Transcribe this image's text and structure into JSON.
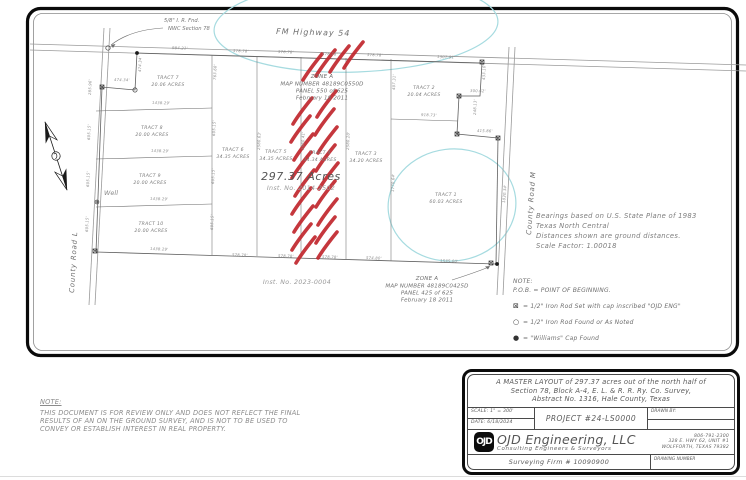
{
  "colors": {
    "flood_hatch": "#c1272d",
    "wetland_outline": "#a6dbe0",
    "drawing_line": "#555555",
    "drawing_text": "#7a7a7a"
  },
  "map": {
    "highway_label": "FM Highway 54",
    "road_left_label": "County Road L",
    "road_right_label": "County Road M",
    "nwc_note_line1": "5/8\" I. R. Fnd.",
    "nwc_note_line2": "NWC Section 78",
    "well_label": "Well",
    "area_label": "297.37 Acres",
    "area_inst_label": "Inst. No. 2014-2502",
    "inst_label_sw": "Inst. No. 2023-0004",
    "zone_a_north": {
      "lines": [
        "ZONE A",
        "MAP NUMBER 48189C0550D",
        "PANEL 550 of 625",
        "February 18 2011"
      ]
    },
    "zone_a_south": {
      "lines": [
        "ZONE A",
        "MAP NUMBER 48189C0425D",
        "PANEL 425 of 625",
        "February 18 2011"
      ]
    },
    "tracts": [
      {
        "name": "TRACT 1",
        "acres": "60.03 ACRES"
      },
      {
        "name": "TRACT 2",
        "acres": "20.04 ACRES"
      },
      {
        "name": "TRACT 3",
        "acres": "34.20 ACRES"
      },
      {
        "name": "TRACT 4",
        "acres": "34.34 ACRES"
      },
      {
        "name": "TRACT 5",
        "acres": "34.35 ACRES"
      },
      {
        "name": "TRACT 6",
        "acres": "34.35 ACRES"
      },
      {
        "name": "TRACT 7",
        "acres": "20.06 ACRES"
      },
      {
        "name": "TRACT 8",
        "acres": "20.00 ACRES"
      },
      {
        "name": "TRACT 9",
        "acres": "20.00 ACRES"
      },
      {
        "name": "TRACT 10",
        "acres": "20.00 ACRES"
      }
    ],
    "dimensions": [
      {
        "label": "984.21'",
        "x": 172,
        "y": 49,
        "r": 2
      },
      {
        "label": "578.78'",
        "x": 233,
        "y": 52,
        "r": 2
      },
      {
        "label": "578.78'",
        "x": 278,
        "y": 53,
        "r": 2
      },
      {
        "label": "578.78'",
        "x": 322,
        "y": 55,
        "r": 2
      },
      {
        "label": "578.78'",
        "x": 367,
        "y": 56,
        "r": 2
      },
      {
        "label": "1307.91'",
        "x": 437,
        "y": 58,
        "r": 2
      },
      {
        "label": "1438.29'",
        "x": 150,
        "y": 250,
        "r": 2
      },
      {
        "label": "578.78'",
        "x": 232,
        "y": 256,
        "r": 2
      },
      {
        "label": "578.78'",
        "x": 278,
        "y": 257,
        "r": 2
      },
      {
        "label": "578.78'",
        "x": 322,
        "y": 258,
        "r": 2
      },
      {
        "label": "574.80'",
        "x": 366,
        "y": 259,
        "r": 2
      },
      {
        "label": "1535.00'",
        "x": 440,
        "y": 262,
        "r": 2
      },
      {
        "label": "1438.29'",
        "x": 152,
        "y": 104,
        "r": 1
      },
      {
        "label": "1438.29'",
        "x": 151,
        "y": 152,
        "r": 1
      },
      {
        "label": "1438.29'",
        "x": 150,
        "y": 200,
        "r": 1
      },
      {
        "label": "474.34'",
        "x": 114,
        "y": 81,
        "r": 1
      },
      {
        "label": "474.34'",
        "x": 141,
        "y": 72,
        "r": -88
      },
      {
        "label": "763.68'",
        "x": 216,
        "y": 80,
        "r": -88
      },
      {
        "label": "605.15'",
        "x": 215,
        "y": 136,
        "r": -88
      },
      {
        "label": "605.15'",
        "x": 214,
        "y": 184,
        "r": -88
      },
      {
        "label": "605.15'",
        "x": 213,
        "y": 230,
        "r": -88
      },
      {
        "label": "2580.63'",
        "x": 260,
        "y": 150,
        "r": -88
      },
      {
        "label": "2580.41'",
        "x": 304,
        "y": 150,
        "r": -88
      },
      {
        "label": "2580.20'",
        "x": 349,
        "y": 150,
        "r": -88
      },
      {
        "label": "1770.64'",
        "x": 394,
        "y": 192,
        "r": -88
      },
      {
        "label": "407.31'",
        "x": 395,
        "y": 90,
        "r": -88
      },
      {
        "label": "918.73'",
        "x": 421,
        "y": 116,
        "r": 2
      },
      {
        "label": "300.62'",
        "x": 470,
        "y": 92,
        "r": 1
      },
      {
        "label": "248.13'",
        "x": 476,
        "y": 115,
        "r": -88
      },
      {
        "label": "415.86'",
        "x": 477,
        "y": 132,
        "r": 1
      },
      {
        "label": "433.10'",
        "x": 485,
        "y": 80,
        "r": -88
      },
      {
        "label": "1830.34'",
        "x": 505,
        "y": 203,
        "r": -85
      },
      {
        "label": "285.96'",
        "x": 91,
        "y": 95,
        "r": -88
      },
      {
        "label": "605.15'",
        "x": 90,
        "y": 140,
        "r": -88
      },
      {
        "label": "605.15'",
        "x": 89,
        "y": 187,
        "r": -88
      },
      {
        "label": "605.15'",
        "x": 88,
        "y": 232,
        "r": -88
      }
    ]
  },
  "bearings_block": {
    "line1": "Bearings based on U.S. State Plane of 1983",
    "line2": "Texas North Central",
    "line3": "Distances shown are ground distances.",
    "line4": "Scale Factor: 1.00018"
  },
  "notes_block": {
    "note_label": "NOTE:",
    "pob_line": "P.O.B.  =  POINT OF BEGINNING.",
    "items": [
      {
        "symbol": "⊠",
        "text": "=  1/2\" Iron Rod Set with cap inscribed \"OJD ENG\""
      },
      {
        "symbol": "○",
        "text": "=  1/2\" Iron Rod Found or As Noted"
      },
      {
        "symbol": "●",
        "text": "=  \"Williams\" Cap Found"
      }
    ]
  },
  "review_note": {
    "label": "NOTE:",
    "line1": "THIS DOCUMENT IS FOR REVIEW ONLY AND DOES NOT REFLECT THE FINAL",
    "line2": "RESULTS OF AN ON THE GROUND SURVEY, AND IS NOT TO BE USED TO",
    "line3": "CONVEY OR ESTABLISH INTEREST IN REAL PROPERTY."
  },
  "title_block": {
    "title_line1": "A MASTER LAYOUT of 297.37 acres out of the north half of",
    "title_line2": "Section 78, Block A-4, E. L. & R. R. Ry. Co. Survey,",
    "title_line3": "Abstract No. 1316, Hale County, Texas",
    "scale_line": "SCALE:  1\" = 300'",
    "date_line": "DATE:  6/18/2024",
    "project": "PROJECT #24-LS0000",
    "drawn_by_label": "DRAWN BY:",
    "logo_text": "OJD",
    "company_name": "OJD Engineering, LLC",
    "company_sub": "Consulting Engineers & Surveyors",
    "phone": "806-791-2300",
    "address1": "328 E. HWY 62, UNIT #1",
    "address2": "WOLFFORTH, TEXAS 79382",
    "firm": "Surveying Firm # 10090900",
    "drawing_number_label": "DRAWING NUMBER"
  }
}
